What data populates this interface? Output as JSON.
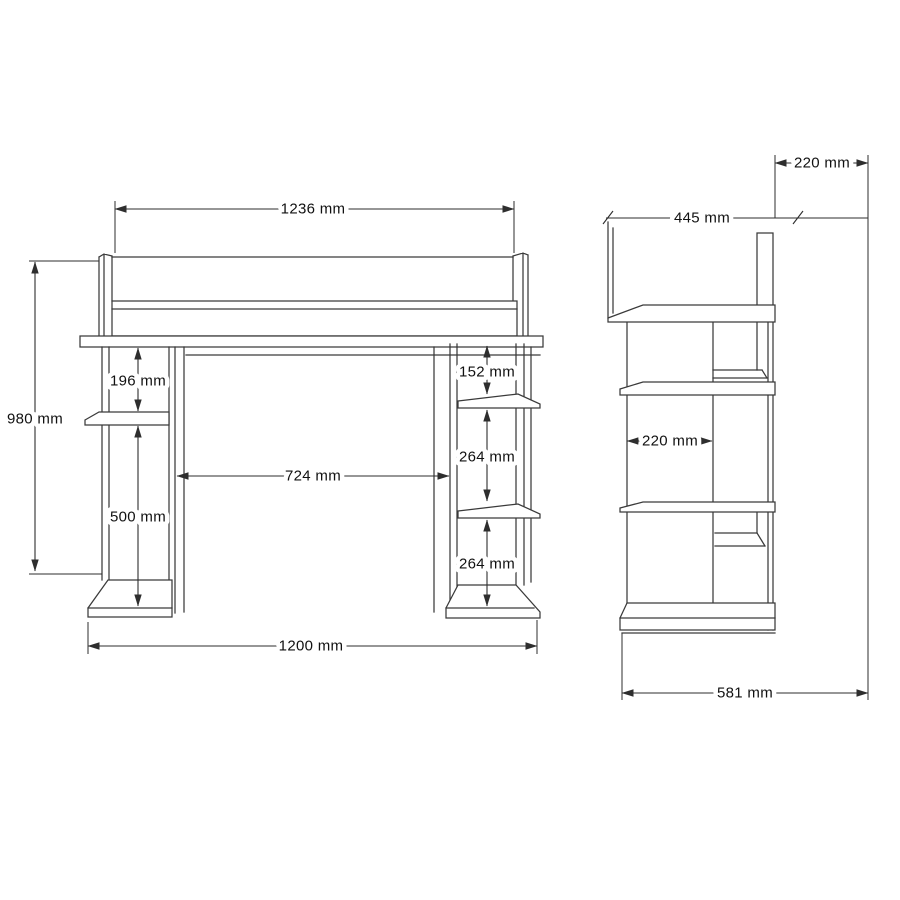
{
  "front_view": {
    "dims": {
      "top_width": "1236 mm",
      "overall_height": "980 mm",
      "left_gap_upper": "196 mm",
      "left_gap_lower": "500 mm",
      "opening_width": "724 mm",
      "right_gap_upper": "152 mm",
      "right_gap_middle": "264 mm",
      "right_gap_lower": "264 mm",
      "bottom_width": "1200 mm"
    }
  },
  "side_view": {
    "dims": {
      "top_offset": "220 mm",
      "upper_depth": "445 mm",
      "inner_depth": "220 mm",
      "bottom_depth": "581 mm"
    }
  }
}
